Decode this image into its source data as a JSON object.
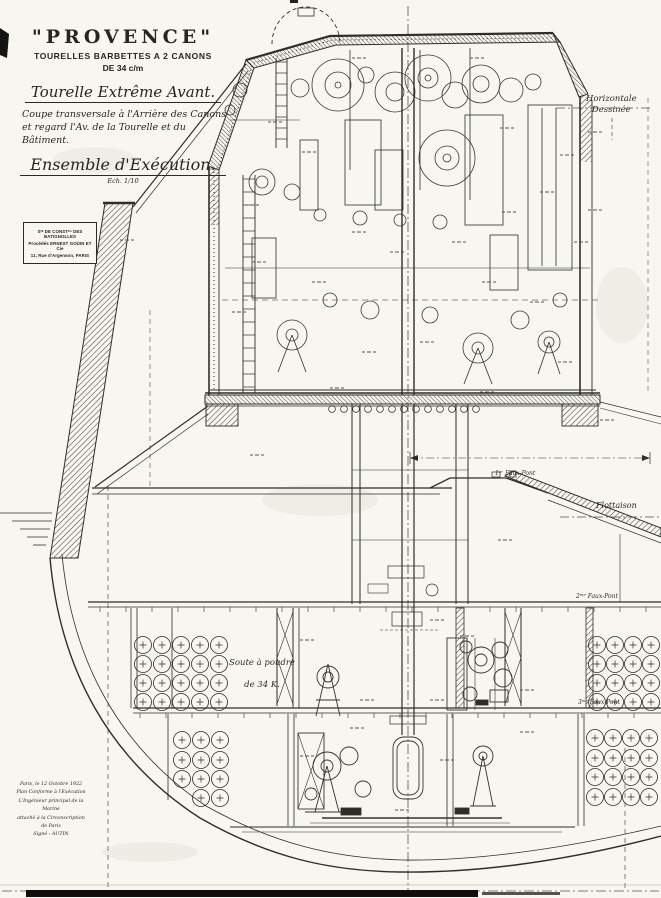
{
  "title_block": {
    "ship_name": "\"PROVENCE\"",
    "subtitle1": "TOURELLES BARBETTES A 2 CANONS",
    "subtitle2": "DE 34 c/m",
    "drawing_title": "Tourelle Extrême Avant.",
    "description_line1": "Coupe transversale à l'Arrière des Canons",
    "description_line2": "et regard l'Av. de la Tourelle et du Bâtiment.",
    "drawing_type": "Ensemble d'Exécution.",
    "scale_note": "Ech. 1/10"
  },
  "maker_stamp": {
    "line1": "Sᵗᵉ DE CONSTᵒⁿ DES BATIGNOLLES",
    "line2": "Procédés ERNEST GOÜIN ET Cie",
    "line3": "11, Rue d'Argenson, PARIS"
  },
  "approval_block": {
    "line1": "Paris, le 12 Octobre 1922",
    "line2": "Plan Conforme à l'Exécution",
    "line3": "L'Ingénieur principal de la Marine",
    "line4": "attaché à la Circonscription de Paris",
    "line5": "Signé : AUTIN"
  },
  "annotations": {
    "horizontal_ref_line1": "Horizontale",
    "horizontal_ref_line2": "Dessinée",
    "waterline_label": "Flottaison",
    "deck1_label": "1ᵉʳ Faux-Pont",
    "deck2_label": "2ᵐᵉ Faux-Pont",
    "deck3_label": "3ᵐᵉ Faux-Pont",
    "magazine_line1": "Soute à poudre",
    "magazine_line2": "de 34 K."
  },
  "colors": {
    "paper": "#f7f6f1",
    "ink": "#2e2d29",
    "hatch": "#44423c"
  }
}
